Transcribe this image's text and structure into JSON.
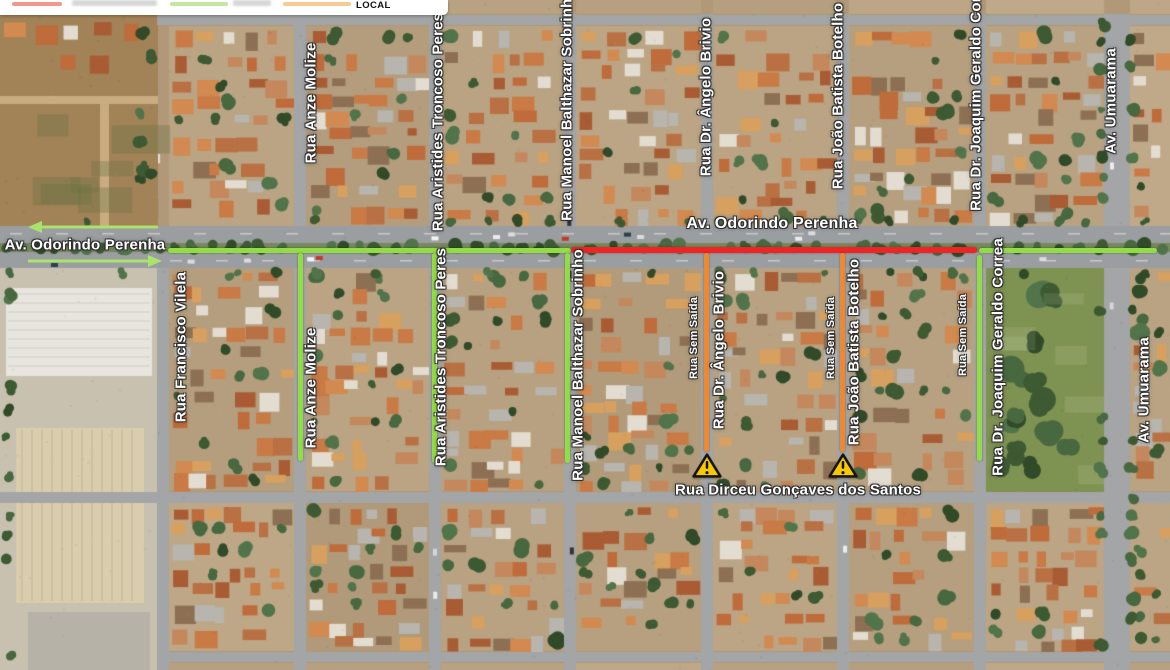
{
  "legend": {
    "items": [
      {
        "name": "route-closed",
        "swatch_color": "#f2978e",
        "label": ""
      },
      {
        "name": "route-open",
        "swatch_color": "#c3e79e",
        "label": ""
      },
      {
        "name": "route-local",
        "swatch_color": "#f8cb95",
        "label": "LOCAL"
      }
    ]
  },
  "colors": {
    "open": "#92dd45",
    "closed": "#ee2524",
    "local": "#f0882f",
    "arrow": "#a9e36d",
    "warning_fill": "#f7c700",
    "warning_ink": "#141414"
  },
  "labels": [
    {
      "id": "rua-anze-molize-north",
      "text": "Rua Anze Molize",
      "x": 311,
      "y": 103,
      "rot": -90,
      "size": 15
    },
    {
      "id": "rua-aristides-troncoso-peres-north",
      "text": "Rua Aristides Troncoso Peres",
      "x": 438,
      "y": 122,
      "rot": -90,
      "size": 15
    },
    {
      "id": "rua-manoel-balthazar-sobrinho-north",
      "text": "Rua Manoel Balthazar Sobrinho",
      "x": 567,
      "y": 105,
      "rot": -90,
      "size": 15
    },
    {
      "id": "rua-dr-angelo-brivio-north",
      "text": "Rua Dr. Ângelo Brivio",
      "x": 706,
      "y": 97,
      "rot": -90,
      "size": 15
    },
    {
      "id": "rua-joao-batista-botelho-north",
      "text": "Rua João Batista Botelho",
      "x": 838,
      "y": 96,
      "rot": -90,
      "size": 15
    },
    {
      "id": "rua-dr-joaquim-geraldo-correa-north",
      "text": "Rua Dr. Joaquim Geraldo Correa",
      "x": 976,
      "y": 92,
      "rot": -90,
      "size": 15
    },
    {
      "id": "av-umuarama-north",
      "text": "Av. Umuarama",
      "x": 1111,
      "y": 101,
      "rot": -90,
      "size": 15
    },
    {
      "id": "rua-francisco-vilela",
      "text": "Rua Francisco Vilela",
      "x": 181,
      "y": 347,
      "rot": -90,
      "size": 15
    },
    {
      "id": "rua-anze-molize-south",
      "text": "Rua Anze Molize",
      "x": 311,
      "y": 388,
      "rot": -90,
      "size": 15
    },
    {
      "id": "rua-aristides-troncoso-peres-south",
      "text": "Rua Aristides Troncoso Peres",
      "x": 441,
      "y": 357,
      "rot": -90,
      "size": 15
    },
    {
      "id": "rua-manoel-balthazar-sobrinho-south",
      "text": "Rua Manoel Balthazar Sobrinho",
      "x": 578,
      "y": 365,
      "rot": -90,
      "size": 15
    },
    {
      "id": "rua-sem-saida-1",
      "text": "Rua Sem Saída",
      "x": 694,
      "y": 338,
      "rot": -90,
      "size": 11
    },
    {
      "id": "rua-dr-angelo-brivio-south",
      "text": "Rua Dr. Ângelo Brivio",
      "x": 719,
      "y": 350,
      "rot": -90,
      "size": 15
    },
    {
      "id": "rua-sem-saida-2",
      "text": "Rua Sem Saída",
      "x": 831,
      "y": 338,
      "rot": -90,
      "size": 11
    },
    {
      "id": "rua-joao-batista-botelho-south",
      "text": "Rua João Batista Botelho",
      "x": 854,
      "y": 352,
      "rot": -90,
      "size": 15
    },
    {
      "id": "rua-sem-saida-3",
      "text": "Rua Sem Saída",
      "x": 963,
      "y": 335,
      "rot": -90,
      "size": 11
    },
    {
      "id": "rua-dr-joaquim-geraldo-correa-south",
      "text": "Rua Dr. Joaquim Geraldo Correa",
      "x": 998,
      "y": 357,
      "rot": -90,
      "size": 15
    },
    {
      "id": "av-umuarama-south",
      "text": "Av. Umuarama",
      "x": 1144,
      "y": 390,
      "rot": -90,
      "size": 15
    },
    {
      "id": "av-odorindo-perenha-west",
      "text": "Av. Odorindo Perenha",
      "x": 85,
      "y": 245,
      "rot": 0,
      "size": 15
    },
    {
      "id": "av-odorindo-perenha-center",
      "text": "Av. Odorindo Perenha",
      "x": 772,
      "y": 224,
      "rot": 0,
      "size": 16
    },
    {
      "id": "rua-dirceu-goncaves-dos-santos",
      "text": "Rua Dirceu Gonçaves dos Santos",
      "x": 798,
      "y": 490,
      "rot": 0,
      "size": 15
    }
  ],
  "warnings": [
    {
      "icon": "warning-triangle",
      "x": 707,
      "y": 466
    },
    {
      "icon": "warning-triangle",
      "x": 843,
      "y": 466
    }
  ]
}
